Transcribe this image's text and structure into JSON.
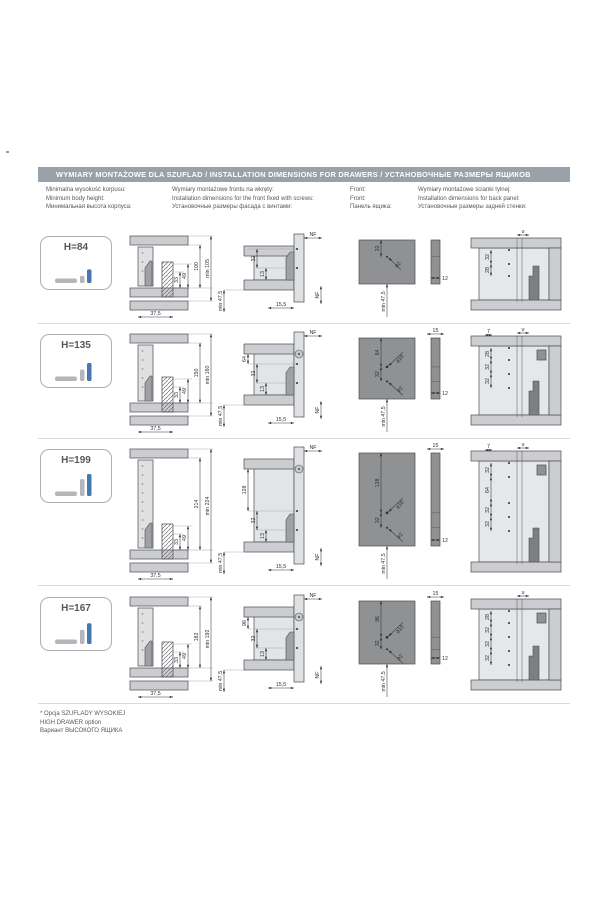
{
  "page": {
    "header": "WYMIARY MONTAŻOWE DLA SZUFLAD / INSTALLATION DIMENSIONS FOR DRAWERS / УСТАНОВОЧНЫЕ РАЗМЕРЫ ЯЩИКОВ",
    "columns": [
      {
        "lines": [
          "Minimalna wysokość korpusu:",
          "Minimum body height:",
          "Минимальная высота корпуса:"
        ]
      },
      {
        "lines": [
          "Wymiary montażowe frontu na wkręty:",
          "Installation dimensions for the front fixed with screws:",
          "Установочные размеры фасада с винтами:"
        ]
      },
      {
        "lines": [
          "Front:",
          "Front:",
          "Панель ящика:"
        ]
      },
      {
        "lines": [
          "Wymiary montażowe ścianki tylnej:",
          "Installation dimensions for back panel:",
          "Установочные размеры задней стенки:"
        ]
      }
    ],
    "footnote": [
      "* Opcja SZUFLADY WYSOKIEJ",
      "HIGH DRAWER option",
      "Вариант ВЫСОКОГО ЯЩИКА"
    ]
  },
  "colors": {
    "header_bg": "#9aa1a8",
    "header_text": "#ffffff",
    "body_text": "#54575c",
    "line": "#2e2f31",
    "panel_light": "#cbcdd0",
    "panel_inner": "#e3e4e6",
    "panel_dark": "#8f9193",
    "profile_gray": "#9fa1a4",
    "accent_blue": "#4677ae",
    "divider": "#d9dadc"
  },
  "rows": [
    {
      "badge": "H=84",
      "height_value": 84,
      "body": {
        "d1": "33",
        "d2": "49",
        "height": "100",
        "min": "min 105",
        "width": "37,5"
      },
      "front_screw": {
        "nf_top": "NF",
        "chain": [
          "32",
          "13"
        ],
        "min": "min 47,5",
        "width": "15,5",
        "nf_right": "NF"
      },
      "front": {
        "chain": [
          "32"
        ],
        "holes": [
          "ø2"
        ],
        "min": "min 47,5",
        "side_width": null,
        "thickness": "12"
      },
      "back": {
        "top_dims": [
          "9"
        ],
        "chain": [
          "32",
          "28"
        ]
      }
    },
    {
      "badge": "H=135",
      "height_value": 135,
      "body": {
        "d1": "33",
        "d2": "49",
        "height": "150",
        "min": "min 160",
        "width": "37,5"
      },
      "front_screw": {
        "nf_top": "NF",
        "chain": [
          "64",
          "32",
          "13"
        ],
        "min": "min 47,5",
        "width": "15,5",
        "nf_right": "NF"
      },
      "front": {
        "chain": [
          "64",
          "32"
        ],
        "holes": [
          "ø10",
          "ø2"
        ],
        "min": "min 47,5",
        "side_width": "15",
        "thickness": "12"
      },
      "back": {
        "top_dims": [
          "7",
          "9"
        ],
        "chain": [
          "28",
          "32",
          "32"
        ]
      }
    },
    {
      "badge": "H=199",
      "height_value": 199,
      "body": {
        "d1": "33",
        "d2": "49",
        "height": "214",
        "min": "min 224",
        "width": "37,5"
      },
      "front_screw": {
        "nf_top": "NF",
        "chain": [
          "128",
          "32",
          "13"
        ],
        "min": "min 47,5",
        "width": "15,5",
        "nf_right": "NF"
      },
      "front": {
        "chain": [
          "128",
          "32"
        ],
        "holes": [
          "ø10",
          "ø2"
        ],
        "min": "min 47,5",
        "side_width": "15",
        "thickness": "12"
      },
      "back": {
        "top_dims": [
          "7",
          "9"
        ],
        "chain": [
          "32",
          "64",
          "32",
          "32"
        ]
      }
    },
    {
      "badge": "H=167",
      "height_value": 167,
      "body": {
        "d1": "33",
        "d2": "49",
        "height": "182",
        "min": "min 192",
        "width": "37,5"
      },
      "front_screw": {
        "nf_top": "NF",
        "chain": [
          "96",
          "32",
          "13"
        ],
        "min": "min 47,5",
        "width": "15,5",
        "nf_right": "NF"
      },
      "front": {
        "chain": [
          "96",
          "32"
        ],
        "holes": [
          "ø10",
          "ø2"
        ],
        "min": "min 47,5",
        "side_width": "15",
        "thickness": "12"
      },
      "back": {
        "top_dims": [
          "9"
        ],
        "chain": [
          "28",
          "32",
          "32",
          "32"
        ]
      }
    }
  ]
}
